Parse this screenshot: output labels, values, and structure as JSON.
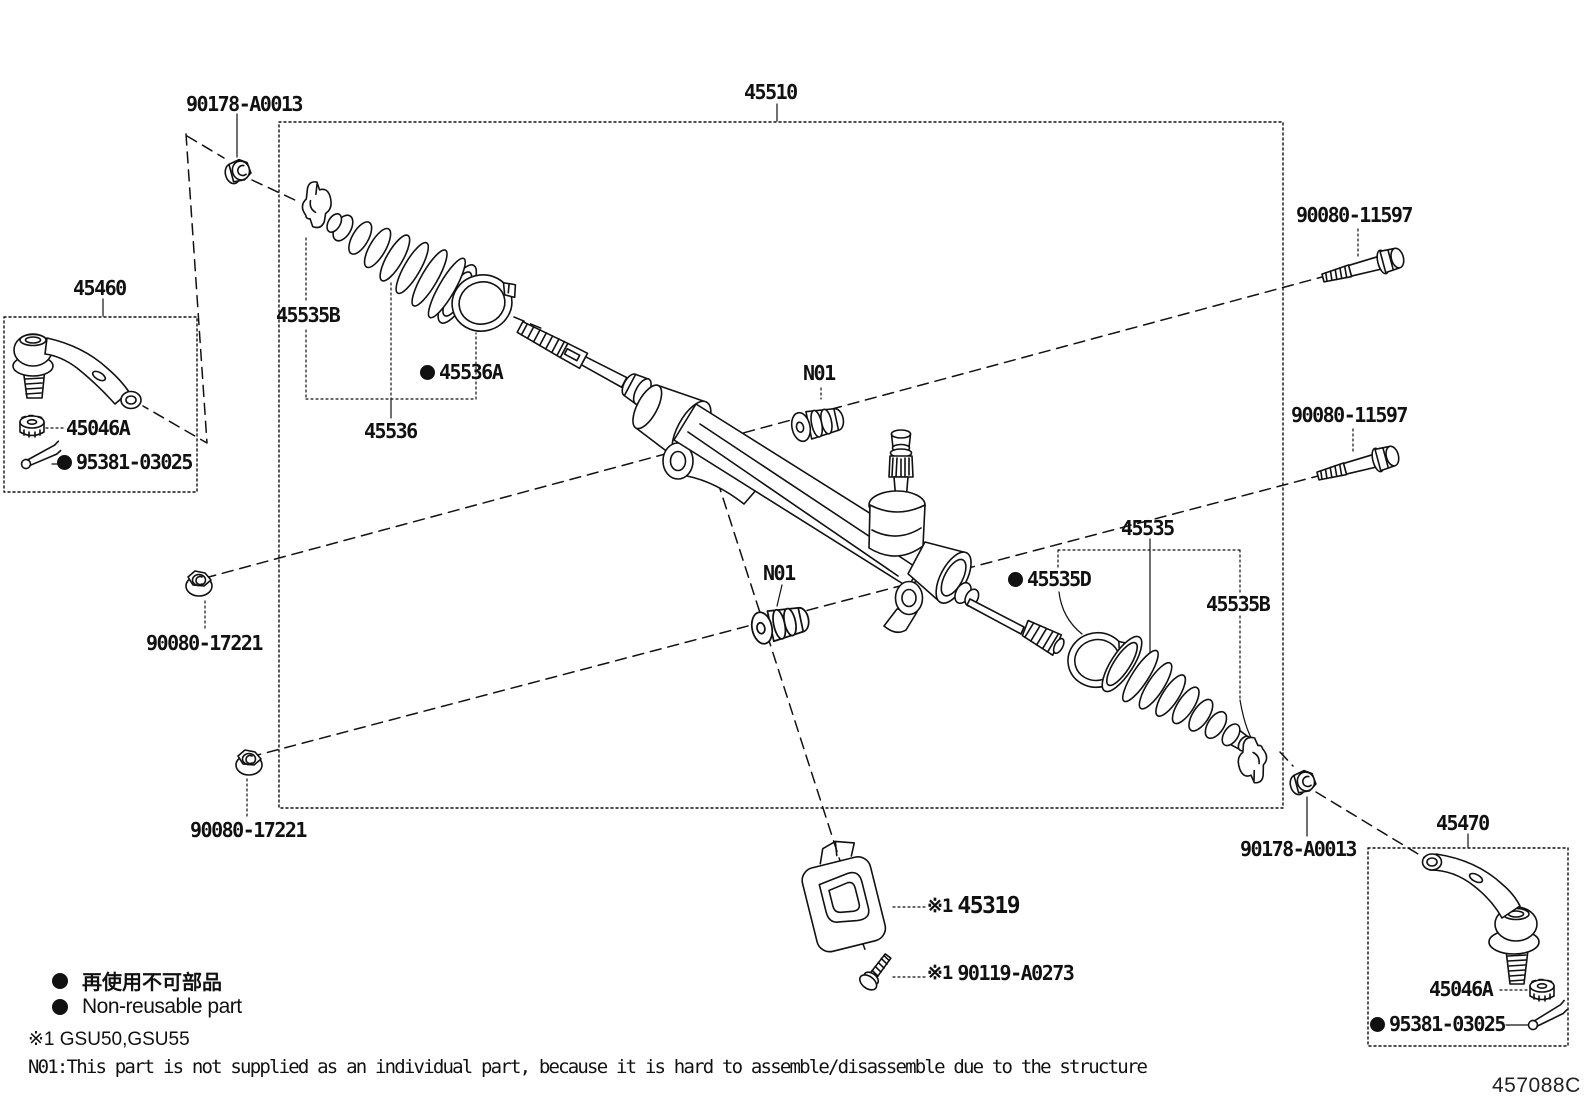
{
  "labels": {
    "assembly": "45510",
    "tie_rod_left": "45460",
    "tie_rod_right": "45470",
    "tie_rod_lock_nut": "90178-A0013",
    "boot_clamp_b": "45535B",
    "boot_clamp_a": "45536A",
    "boot_left": "45536",
    "castle_nut": "45046A",
    "cotter_pin": "95381-03025",
    "bushing_note": "N01",
    "housing_bolt": "90080-11597",
    "boot_right": "45535",
    "boot_clamp_d": "45535D",
    "housing_nut": "90080-17221",
    "column_hole_cover": "45319",
    "cover_bolt": "90119-A0273",
    "ref_mark": "※1",
    "diagram_code": "457088C"
  },
  "legend": {
    "non_reusable_jp": "再使用不可部品",
    "non_reusable_en": "Non-reusable part",
    "ref_applicability": "※1 GSU50,GSU55",
    "note_n01": "N01:This part is not supplied as an individual part, because it is hard to assemble/disassemble due to the structure"
  }
}
